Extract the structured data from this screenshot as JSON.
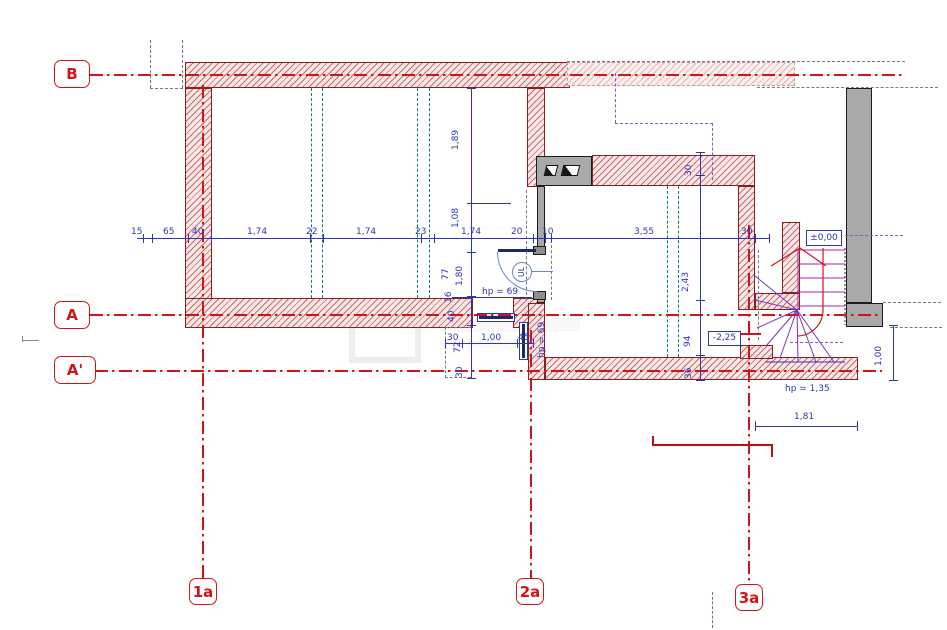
{
  "grid_markers": {
    "b": "B",
    "a": "A",
    "a2": "A'",
    "c1": "1a",
    "c2": "2a",
    "c3": "3a"
  },
  "dim_row": [
    "15",
    "65",
    "40",
    "1,74",
    "22",
    "1,74",
    "23",
    "1,74",
    "20",
    "10",
    "3,55",
    "30"
  ],
  "dim_col_mid": [
    "1,89",
    "1,08",
    "77",
    "1,80",
    "16",
    "40"
  ],
  "dim_col_right": [
    "30",
    "2,43",
    "94",
    "36"
  ],
  "dim_bay": [
    "30",
    "72",
    "1,00",
    "45",
    "30"
  ],
  "dim_misc": {
    "w181": "1,81",
    "h100": "1,00"
  },
  "levels": {
    "ground": "±0,00",
    "basement": "-2,25"
  },
  "parapet": {
    "door": "hp =  69",
    "side": "hp =  69",
    "stair": "hp =  1,35"
  },
  "symbols": {
    "circle_label": "UL"
  },
  "colors": {
    "wall_hatch": "#c74848",
    "wall_outline": "#8f1d1d",
    "grid_red": "#cf1515",
    "dimension_blue": "#2b35b5",
    "teal_dashed": "#0e7b7b",
    "purple_dashed": "#8a55cc",
    "gray_fill": "#a9a9a9",
    "stair_magenta": "#a825a8"
  }
}
